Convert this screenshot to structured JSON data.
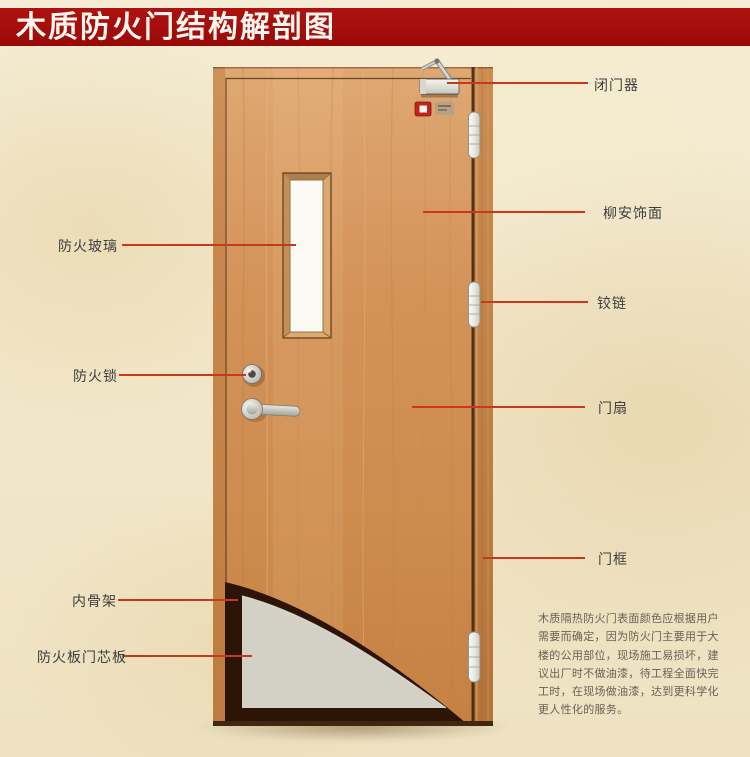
{
  "title": "木质防火门结构解剖图",
  "labels": {
    "left": [
      {
        "id": "fire-glass",
        "text": "防火玻璃"
      },
      {
        "id": "fire-lock",
        "text": "防火锁"
      },
      {
        "id": "inner-skeleton",
        "text": "内骨架"
      },
      {
        "id": "fire-board-core",
        "text": "防火板门芯板"
      }
    ],
    "right": [
      {
        "id": "door-closer",
        "text": "闭门器"
      },
      {
        "id": "lauan-veneer",
        "text": "柳安饰面"
      },
      {
        "id": "hinge",
        "text": "铰链"
      },
      {
        "id": "door-leaf",
        "text": "门扇"
      },
      {
        "id": "door-frame",
        "text": "门框"
      }
    ]
  },
  "description_lines": [
    "木质隔热防火门表面颜色应根据用户",
    "需要而确定，因为防火门主要用于大",
    "楼的公用部位，现场施工易损坏，建",
    "议出厂时不做油漆，待工程全面快完",
    "工时，在现场做油漆，达到更科学化",
    "更人性化的服务。"
  ],
  "colors": {
    "banner_red": "#a40e0c",
    "leader_line_red": "#c8391b",
    "door_wood": "#d29156",
    "core_gray": "#d3d0c6",
    "background_beige": "#f2e8cd"
  }
}
